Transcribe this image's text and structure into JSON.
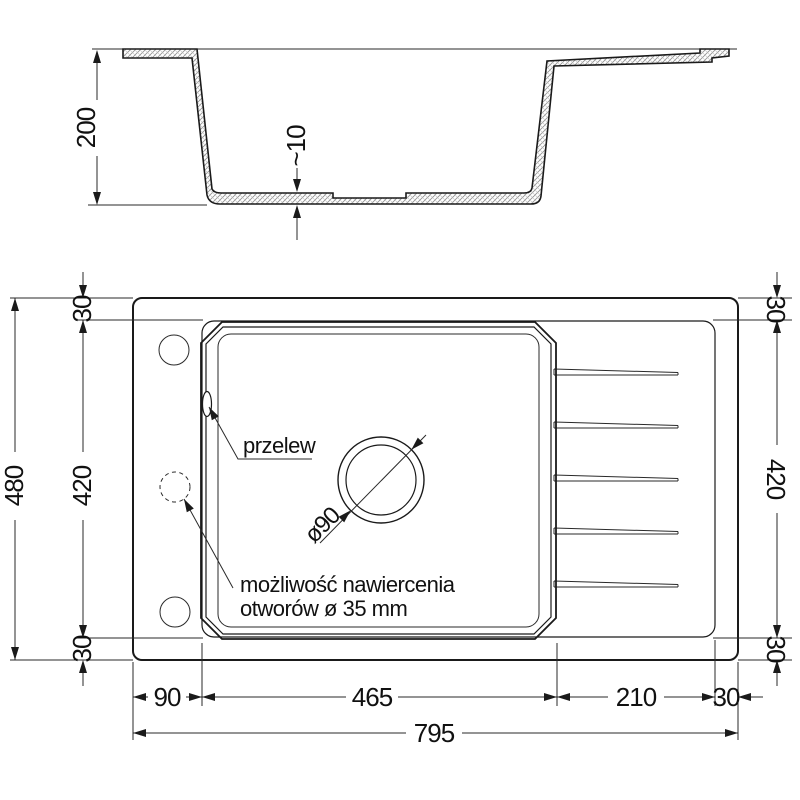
{
  "section": {
    "depth": "200",
    "bottom_thickness": "~10"
  },
  "plan": {
    "overflow": "przelew",
    "drill_note_line1": "możliwość nawiercenia",
    "drill_note_line2": "otworów ø 35 mm",
    "drain_diameter": "ø90",
    "dims": {
      "total_width": "795",
      "total_height": "480",
      "inner_height_left": "420",
      "inner_height_right": "420",
      "rim_top_left": "30",
      "rim_bottom_left": "30",
      "rim_top_right": "30",
      "rim_bottom_right": "30",
      "left_offset": "90",
      "bowl_width": "465",
      "drainer_width": "210",
      "right_offset": "30"
    }
  }
}
